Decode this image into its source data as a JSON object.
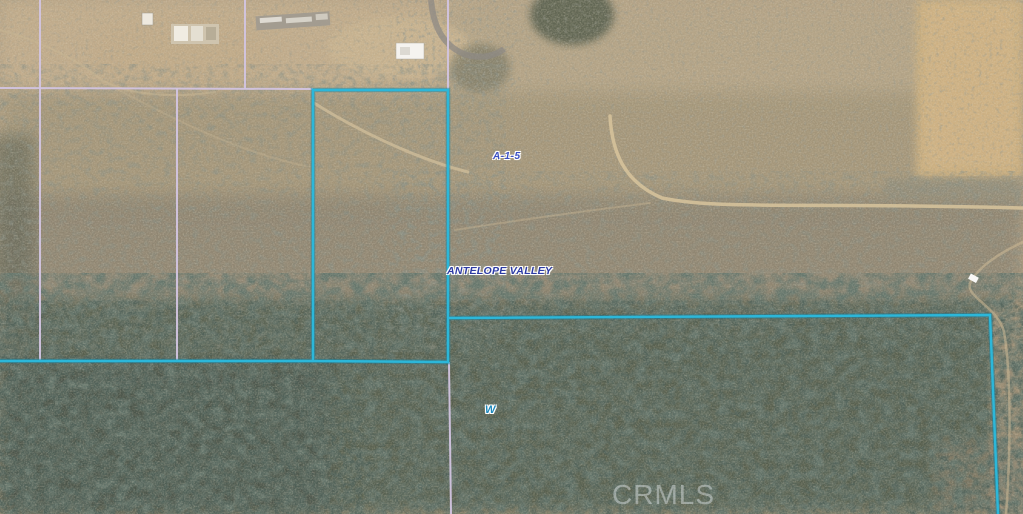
{
  "map": {
    "description": "Aerial satellite parcel map with highlighted listing boundary",
    "watermark": "CRMLS",
    "labels": {
      "zoning": {
        "text": "A-1-5"
      },
      "area": {
        "text": "ANTELOPE VALLEY"
      },
      "street": {
        "text": "W"
      }
    },
    "colors": {
      "highlight_line": "#2cb7d9",
      "highlight_line_dark": "#117e9e",
      "parcel_line": "#d2c4e0",
      "zoning_label": "#3a4fc4",
      "area_label": "#2b3aa4",
      "street_label": "#1b87bb",
      "watermark": "rgba(235,240,245,0.42)"
    }
  }
}
